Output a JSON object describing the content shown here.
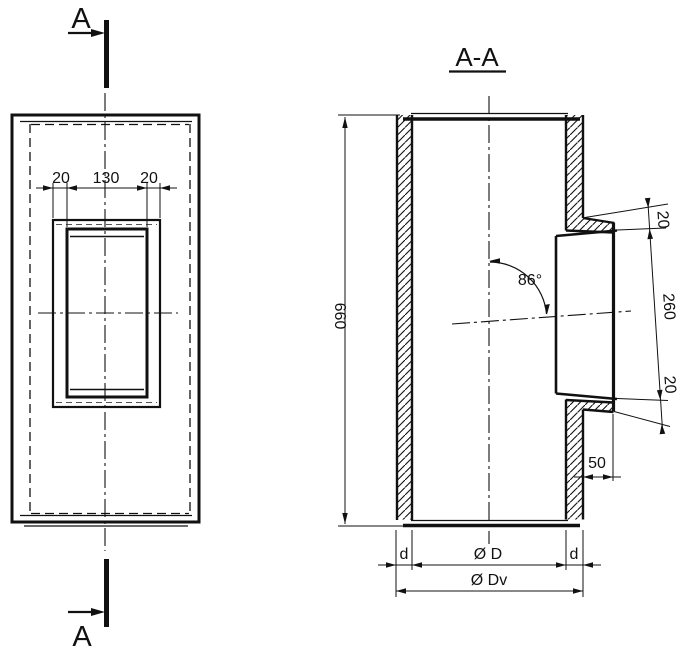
{
  "drawing": {
    "background_color": "#ffffff",
    "line_color": "#111111",
    "section_marker_top": "A",
    "section_marker_bottom": "A",
    "section_title": "A-A",
    "front_view": {
      "dim_flange_border_left": "20",
      "dim_flange_inner_width": "130",
      "dim_flange_border_right": "20"
    },
    "section_view": {
      "dim_body_height": "660",
      "dim_branch_angle": "86°",
      "dim_branch_offset_top": "20",
      "dim_branch_diameter": "260",
      "dim_branch_offset_bottom": "20",
      "dim_ledge_width": "50",
      "dim_wall_thickness_left": "d",
      "dim_inner_diameter": "Ø D",
      "dim_wall_thickness_right": "d",
      "dim_outer_diameter": "Ø Dv"
    }
  }
}
